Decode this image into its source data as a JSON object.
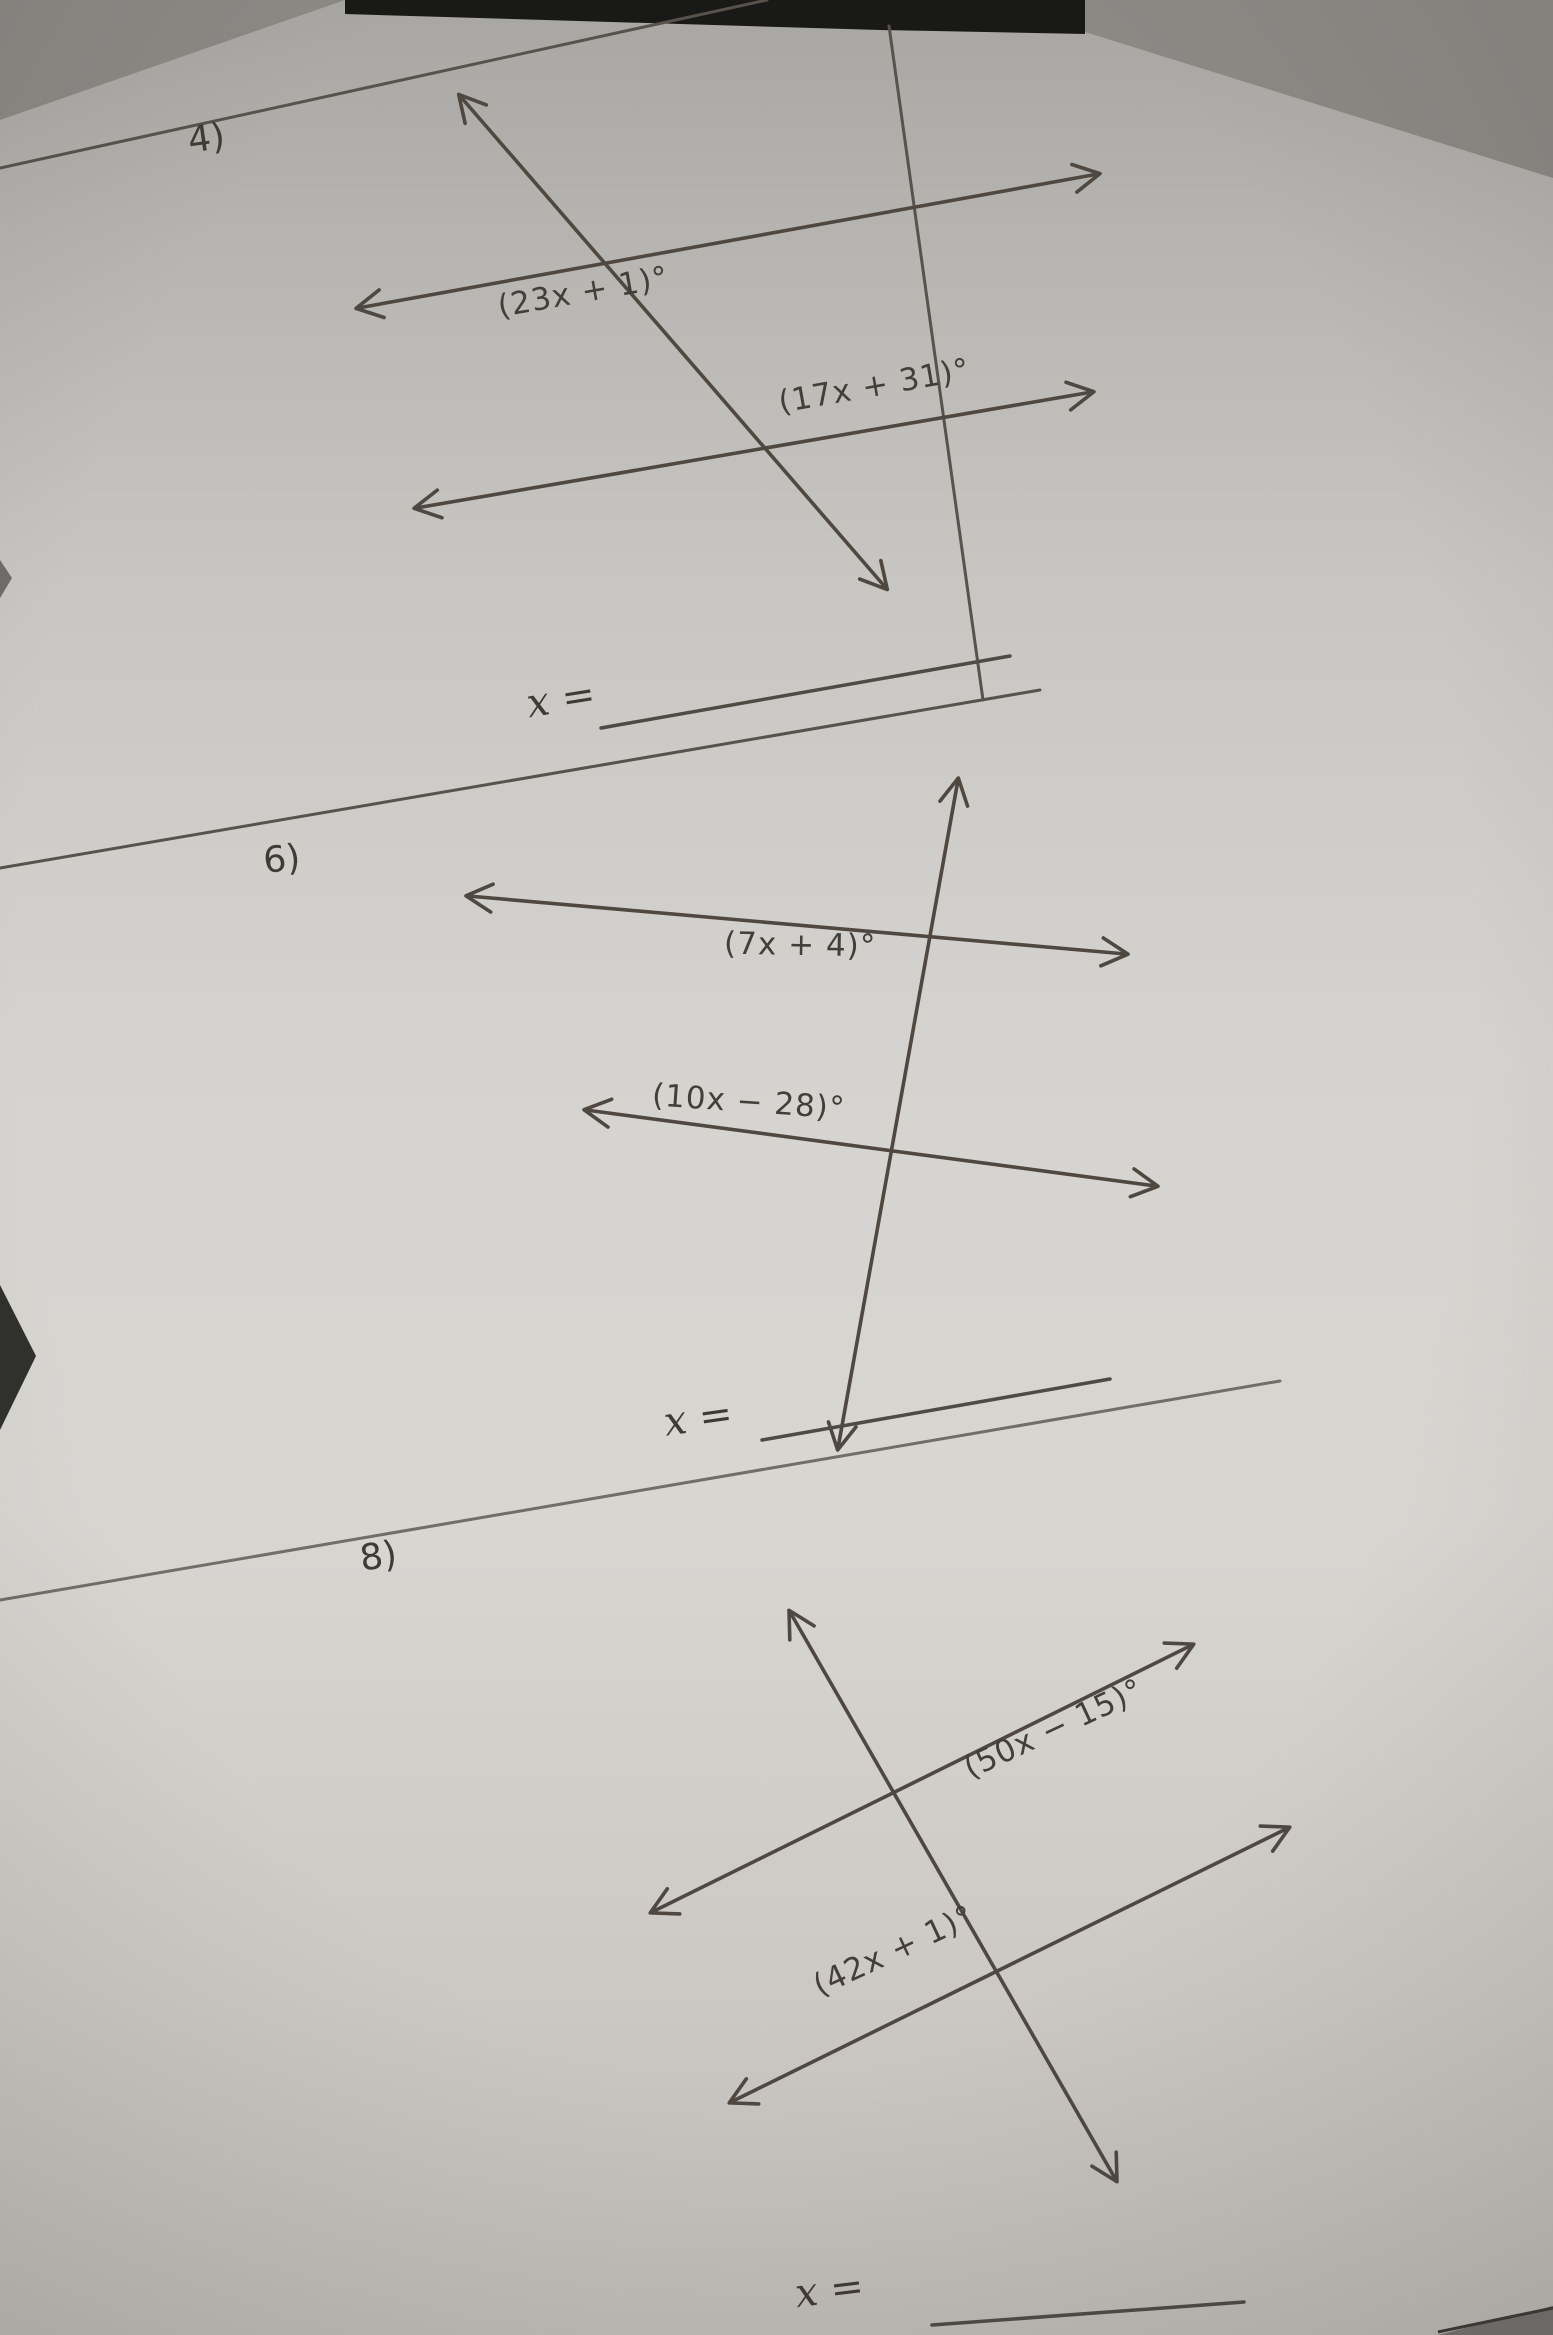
{
  "photo": {
    "description": "Photographed geometry worksheet: parallel lines cut by a transversal, solve for x"
  },
  "problems": [
    {
      "number": "4)",
      "angle_top": "(23x + 1)°",
      "angle_bottom": "(17x + 31)°",
      "answer_label": "x ="
    },
    {
      "number": "6)",
      "angle_top": "(7x + 4)°",
      "angle_bottom": "(10x − 28)°",
      "answer_label": "x ="
    },
    {
      "number": "8)",
      "angle_top": "(50x − 15)°",
      "angle_bottom": "(42x + 1)°",
      "answer_label": "x ="
    }
  ]
}
